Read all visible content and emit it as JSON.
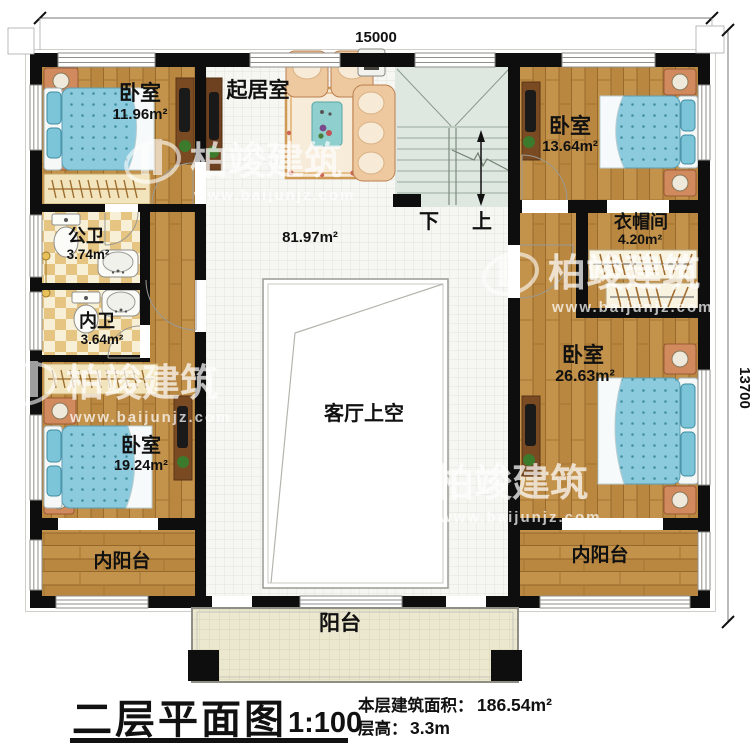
{
  "dimensions": {
    "top": "15000",
    "right": "13700"
  },
  "rooms": {
    "bedroom_top_left": {
      "name": "卧室",
      "area": "11.96m²"
    },
    "living_room": {
      "name": "起居室"
    },
    "bedroom_top_right": {
      "name": "卧室",
      "area": "13.64m²"
    },
    "cloakroom": {
      "name": "衣帽间",
      "area": "4.20m²"
    },
    "public_bathroom": {
      "name": "公卫",
      "area": "3.74m²"
    },
    "private_bathroom": {
      "name": "内卫",
      "area": "3.64m²"
    },
    "hall": {
      "area": "81.97m²"
    },
    "living_void": {
      "name": "客厅上空"
    },
    "bedroom_bottom_right": {
      "name": "卧室",
      "area": "26.63m²"
    },
    "bedroom_bottom_left": {
      "name": "卧室",
      "area": "19.24m²"
    },
    "inner_balcony_left": {
      "name": "内阳台"
    },
    "inner_balcony_right": {
      "name": "内阳台"
    },
    "balcony": {
      "name": "阳台"
    }
  },
  "stairs": {
    "down_label": "下",
    "up_label": "上"
  },
  "title_block": {
    "title": "二层平面图",
    "scale": "1:100",
    "area_label": "本层建筑面积：",
    "area_value": "186.54m²",
    "height_label": "层高：",
    "height_value": "3.3m"
  },
  "watermark": {
    "brand": "柏竣建筑",
    "url": "www.baijunjz.com"
  },
  "colors": {
    "wall": "#0e0e0e",
    "wood_floor": "#b9873f",
    "bed_blue": "#8ccadd",
    "bath_checker": "#e6c583",
    "stair_green": "#dfe7e1",
    "balcony_khaki": "#ece8cf",
    "furniture_peach": "#eec9a0"
  }
}
